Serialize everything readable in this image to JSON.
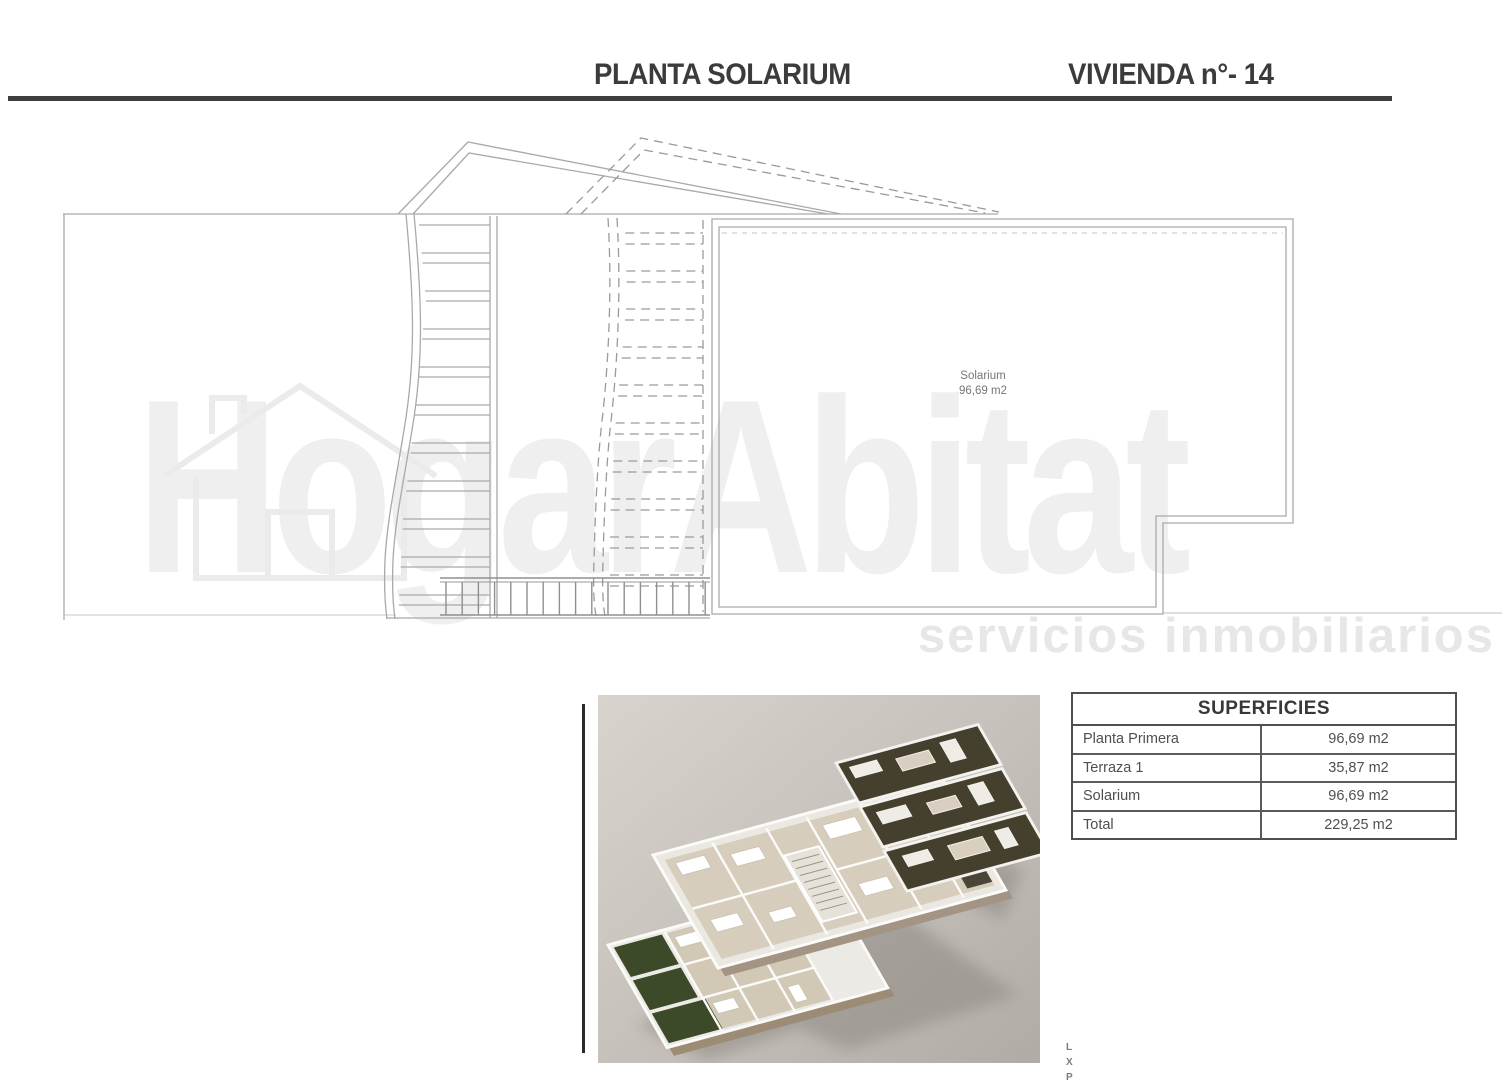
{
  "header": {
    "title_left": "PLANTA SOLARIUM",
    "title_right": "VIVIENDA n°- 14"
  },
  "plan": {
    "room_label": "Solarium",
    "room_area": "96,69 m2"
  },
  "watermark": {
    "brand": "HogarAbitat",
    "tagline": "servicios inmobiliarios"
  },
  "render": {
    "side_label_letters": [
      "L",
      "X",
      "P"
    ]
  },
  "table": {
    "title": "SUPERFICIES",
    "rows": [
      {
        "label": "Planta Primera",
        "value": "96,69 m2"
      },
      {
        "label": "Terraza 1",
        "value": "35,87 m2"
      },
      {
        "label": "Solarium",
        "value": "96,69 m2"
      },
      {
        "label": "Total",
        "value": "229,25 m2"
      }
    ]
  },
  "colors": {
    "header_rule": "#3e3e3e",
    "plan_line": "#a9a9a9",
    "garden_green": "#3d4a29",
    "render_bg": "#c4bfb9"
  }
}
